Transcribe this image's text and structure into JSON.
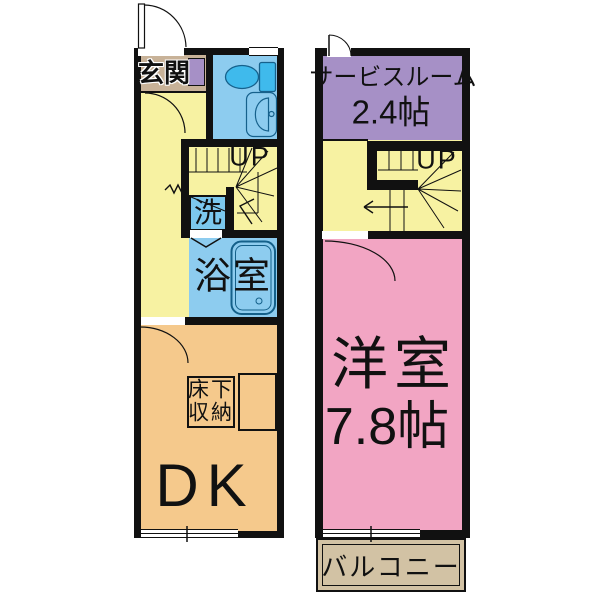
{
  "title": "apartment-floor-plan",
  "colors": {
    "wall": "#111111",
    "hall_yellow": "#F7F2A2",
    "dk_orange": "#F5C98C",
    "western_pink": "#F2A5C3",
    "service_purple": "#A690C6",
    "wet_room_blue": "#8DCCEF",
    "fixture_blue": "#3FBAEC",
    "washer_blue": "#7CC8EE",
    "entrance_tan": "#C8B298",
    "balcony_tan": "#D2C2A4",
    "fixture_outline": "#16618C",
    "background": "#FFFFFF"
  },
  "floor1": {
    "entrance_label": "玄関",
    "stairs_label": "UP",
    "washer_label": "洗",
    "bath_label": "浴室",
    "storage_line1": "床下",
    "storage_line2": "収納",
    "dk_label": "DK",
    "icons": {
      "toilet": "toilet-icon",
      "washbasin": "washbasin-icon",
      "bathtub": "bathtub-icon",
      "entrance_door": "door-swing-icon",
      "stairs": "stair-treads-icon"
    }
  },
  "floor2": {
    "service_room_line1": "サービスルーム",
    "service_room_line2": "2.4帖",
    "stairs_label": "UP",
    "western_room_label": "洋室",
    "western_room_size": "7.8帖",
    "balcony_label": "バルコニー",
    "icons": {
      "entrance_door": "door-swing-icon",
      "stairs": "stair-treads-icon"
    }
  }
}
